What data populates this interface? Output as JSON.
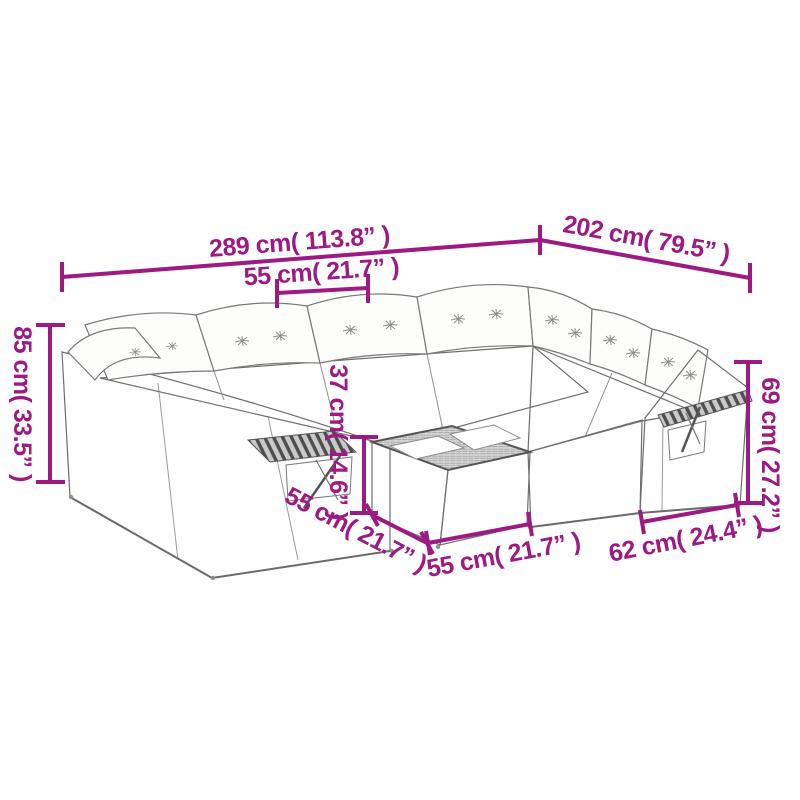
{
  "page": {
    "type": "product-dimension-diagram",
    "background": "#ffffff",
    "accent_color": "#9C1A81",
    "line_art_color": "#6e6e6e",
    "subject": "poly rattan garden corner sofa set with cushions and coffee table"
  },
  "dimensions": {
    "total_width": {
      "label": "289 cm( 113.8” )"
    },
    "return_depth": {
      "label": "202 cm( 79.5” )"
    },
    "seat_width": {
      "label": "55 cm( 21.7” )"
    },
    "back_height_left": {
      "label": "85 cm( 33.5” )"
    },
    "table_height": {
      "label": "37 cm( 14.6” )"
    },
    "arm_height_right": {
      "label": "69 cm( 27.2” )"
    },
    "table_depth": {
      "label": "55 cm( 21.7” )"
    },
    "table_width": {
      "label": "55 cm( 21.7” )"
    },
    "end_section_width": {
      "label": "62 cm( 24.4” )"
    }
  }
}
